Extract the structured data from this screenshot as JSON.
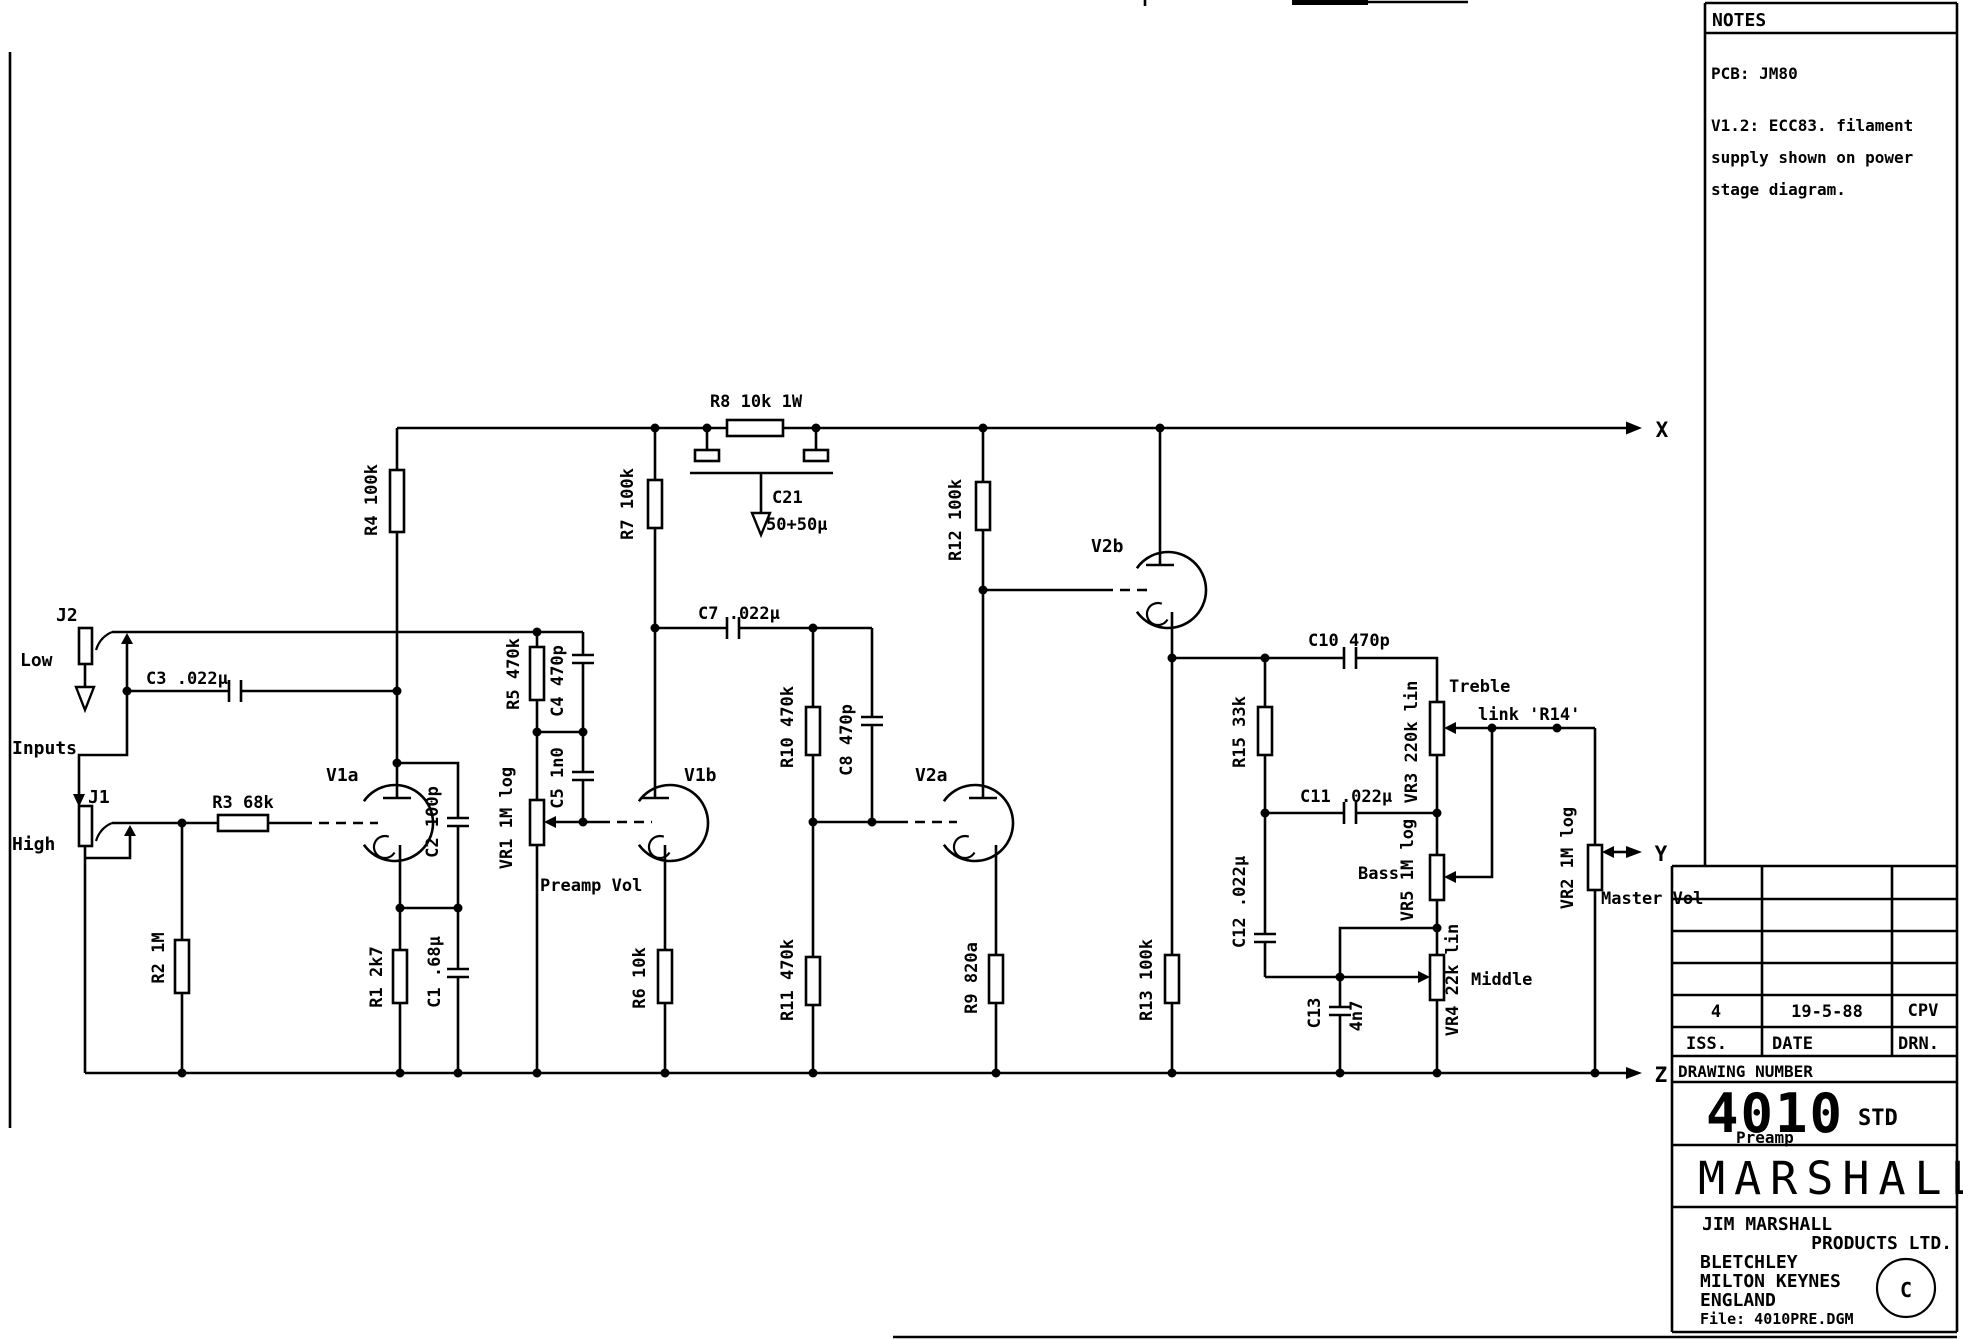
{
  "notes": {
    "title": "NOTES",
    "line1": "PCB: JM80",
    "line2": "V1.2: ECC83. filament",
    "line3": "supply shown on power",
    "line4": "stage diagram."
  },
  "title_block": {
    "iss_value": "4",
    "date_value": "19-5-88",
    "drn_value": "CPV",
    "iss_label": "ISS.",
    "date_label": "DATE",
    "drn_label": "DRN.",
    "drawing_number_label": "DRAWING NUMBER",
    "number": "4010",
    "std": "STD",
    "subtitle": "Preamp",
    "brand": "MARSHALL",
    "company1": "JIM MARSHALL",
    "company2": "PRODUCTS LTD.",
    "company3": "BLETCHLEY",
    "company4": "MILTON KEYNES",
    "company5": "ENGLAND",
    "file": "File: 4010PRE.DGM",
    "copyright": "C"
  },
  "sch": {
    "inputs": "Inputs",
    "low": "Low",
    "high": "High",
    "j1": "J1",
    "j2": "J2",
    "r1": "R1 2k7",
    "r2": "R2 1M",
    "r3": "R3 68k",
    "r4": "R4 100k",
    "r5": "R5 470k",
    "r6": "R6 10k",
    "r7": "R7 100k",
    "r8": "R8 10k 1W",
    "r9": "R9 820a",
    "r10": "R10 470k",
    "r11": "R11 470k",
    "r12": "R12 100k",
    "r13": "R13 100k",
    "r15": "R15 33k",
    "c1": "C1 .68µ",
    "c2": "C2 100p",
    "c3": "C3 .022µ",
    "c4": "C4 470p",
    "c5": "C5 1n0",
    "c7": "C7 .022µ",
    "c8": "C8 470p",
    "c10": "C10 470p",
    "c11": "C11 .022µ",
    "c12": "C12 .022µ",
    "c13_name": "C13",
    "c13_value": "4n7",
    "c21_name": "C21",
    "c21_value": "50+50µ",
    "vr1": "VR1 1M log",
    "vr2": "VR2 1M log",
    "vr3": "VR3 220k lin",
    "vr4": "VR4 22k lin",
    "vr5": "VR5 1M log",
    "v1a": "V1a",
    "v1b": "V1b",
    "v2a": "V2a",
    "v2b": "V2b",
    "preamp_vol": "Preamp Vol",
    "master_vol": "Master Vol",
    "treble": "Treble",
    "bass": "Bass",
    "middle": "Middle",
    "link_r14": "link 'R14'",
    "x": "X",
    "y": "Y",
    "z": "Z"
  }
}
